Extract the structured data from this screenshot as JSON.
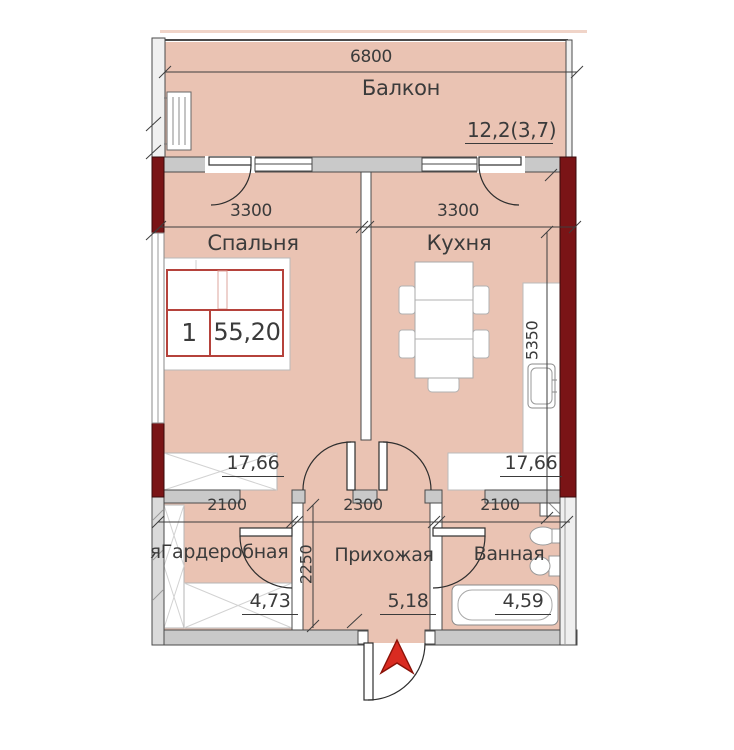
{
  "unit": {
    "number": "1",
    "total_area": "55,20"
  },
  "rooms": {
    "balcony": {
      "label": "Балкон",
      "area": "12,2(3,7)"
    },
    "bedroom": {
      "label": "Спальня",
      "area": "17,66"
    },
    "kitchen": {
      "label": "Кухня",
      "area": "17,66"
    },
    "wardrobe": {
      "label": "яГардеробная",
      "area": "4,73"
    },
    "hallway": {
      "label": "Прихожая",
      "area": "5,18"
    },
    "bathroom": {
      "label": "Ванная",
      "area": "4,59"
    }
  },
  "dimensions": {
    "balcony_width": "6800",
    "bedroom_width": "3300",
    "kitchen_width": "3300",
    "kitchen_depth": "5350",
    "wardrobe_width": "2100",
    "hallway_width": "2300",
    "hallway_depth": "2250",
    "bathroom_width": "2100"
  },
  "colors": {
    "room_fill": "#eac3b3",
    "wall_maroon": "#7a1416",
    "wall_gray": "#cbcbcb",
    "accent_red": "#b5423b",
    "arrow_red": "#d92b21",
    "line": "#3e3e3e"
  }
}
